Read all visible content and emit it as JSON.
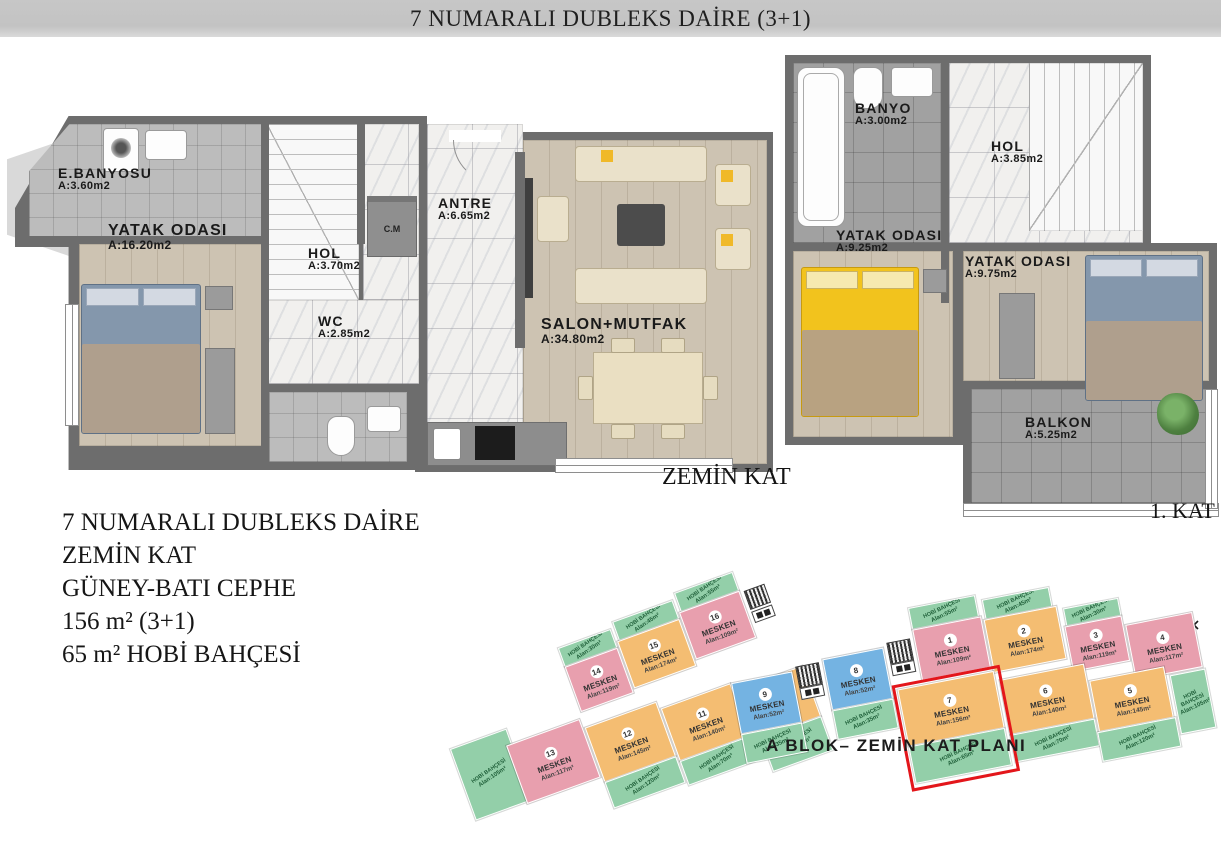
{
  "title_bar": {
    "text": "7 NUMARALI DUBLEKS DAİRE (3+1)"
  },
  "ground_floor": {
    "caption": "ZEMİN KAT",
    "rooms": [
      {
        "name": "E.BANYOSU",
        "area": "A:3.60m2"
      },
      {
        "name": "YATAK ODASI",
        "area": "A:16.20m2"
      },
      {
        "name": "HOL",
        "area": "A:3.70m2"
      },
      {
        "name": "WC",
        "area": "A:2.85m2"
      },
      {
        "name": "ANTRE",
        "area": "A:6.65m2"
      },
      {
        "name": "SALON+MUTFAK",
        "area": "A:34.80m2"
      },
      {
        "name": "C.M",
        "area": ""
      }
    ]
  },
  "first_floor": {
    "caption": "1. KAT",
    "rooms": [
      {
        "name": "BANYO",
        "area": "A:3.00m2"
      },
      {
        "name": "HOL",
        "area": "A:3.85m2"
      },
      {
        "name": "YATAK ODASI",
        "area": "A:9.25m2"
      },
      {
        "name": "YATAK ODASI",
        "area": "A:9.75m2"
      },
      {
        "name": "BALKON",
        "area": "A:5.25m2"
      }
    ]
  },
  "info_block": {
    "lines": [
      "7 NUMARALI DUBLEKS DAİRE",
      "ZEMİN KAT",
      "GÜNEY-BATI CEPHE",
      "156 m² (3+1)",
      "65 m² HOBİ BAHÇESİ"
    ]
  },
  "site_plan": {
    "caption": "A BLOK– ZEMİN KAT PLANI",
    "highlighted_unit": "7",
    "colors": {
      "mesken_pink": "#e89fae",
      "mesken_orange": "#f4bd72",
      "mesken_blue": "#74b3e2",
      "hobi_green": "#93cfa9",
      "highlight_red": "#e3161b"
    },
    "units": [
      {
        "num": "1",
        "label": "MESKEN",
        "area": "Alan:109m²"
      },
      {
        "num": "2",
        "label": "MESKEN",
        "area": "Alan:174m²"
      },
      {
        "num": "3",
        "label": "MESKEN",
        "area": "Alan:119m²"
      },
      {
        "num": "4",
        "label": "MESKEN",
        "area": "Alan:117m²"
      },
      {
        "num": "5",
        "label": "MESKEN",
        "area": "Alan:145m²"
      },
      {
        "num": "6",
        "label": "MESKEN",
        "area": "Alan:140m²"
      },
      {
        "num": "7",
        "label": "MESKEN",
        "area": "Alan:156m²",
        "highlighted": true
      },
      {
        "num": "8",
        "label": "MESKEN",
        "area": "Alan:52m²"
      },
      {
        "num": "9",
        "label": "MESKEN",
        "area": "Alan:52m²"
      },
      {
        "num": "10",
        "label": "MESKEN",
        "area": "Alan:156m²"
      },
      {
        "num": "11",
        "label": "MESKEN",
        "area": "Alan:140m²"
      },
      {
        "num": "12",
        "label": "MESKEN",
        "area": "Alan:145m²"
      },
      {
        "num": "13",
        "label": "MESKEN",
        "area": "Alan:117m²"
      },
      {
        "num": "14",
        "label": "MESKEN",
        "area": "Alan:119m²"
      },
      {
        "num": "15",
        "label": "MESKEN",
        "area": "Alan:174m²"
      },
      {
        "num": "16",
        "label": "MESKEN",
        "area": "Alan:109m²"
      }
    ],
    "gardens": [
      {
        "label": "HOBİ BAHÇESİ",
        "area": "Alan:105m²"
      },
      {
        "label": "HOBİ BAHÇESİ",
        "area": "Alan:30m²"
      },
      {
        "label": "HOBİ BAHÇESİ",
        "area": "Alan:45m²"
      },
      {
        "label": "HOBİ BAHÇESİ",
        "area": "Alan:55m²"
      },
      {
        "label": "HOBİ BAHÇESİ",
        "area": "Alan:120m²"
      },
      {
        "label": "HOBİ BAHÇESİ",
        "area": "Alan:70m²"
      },
      {
        "label": "HOBİ BAHÇESİ",
        "area": "Alan:65m²"
      },
      {
        "label": "HOBİ BAHÇESİ",
        "area": "Alan:35m²"
      },
      {
        "label": "HOBİ BAHÇESİ",
        "area": "Alan:35m²"
      },
      {
        "label": "HOBİ BAHÇESİ",
        "area": "Alan:55m²"
      },
      {
        "label": "HOBİ BAHÇESİ",
        "area": "Alan:45m²"
      },
      {
        "label": "HOBİ BAHÇESİ",
        "area": "Alan:30m²"
      },
      {
        "label": "HOBİ BAHÇESİ",
        "area": "Alan:65m²"
      },
      {
        "label": "HOBİ BAHÇESİ",
        "area": "Alan:70m²"
      },
      {
        "label": "HOBİ BAHÇESİ",
        "area": "Alan:120m²"
      },
      {
        "label": "HOBİ BAHÇESİ",
        "area": "Alan:105m²"
      }
    ]
  }
}
